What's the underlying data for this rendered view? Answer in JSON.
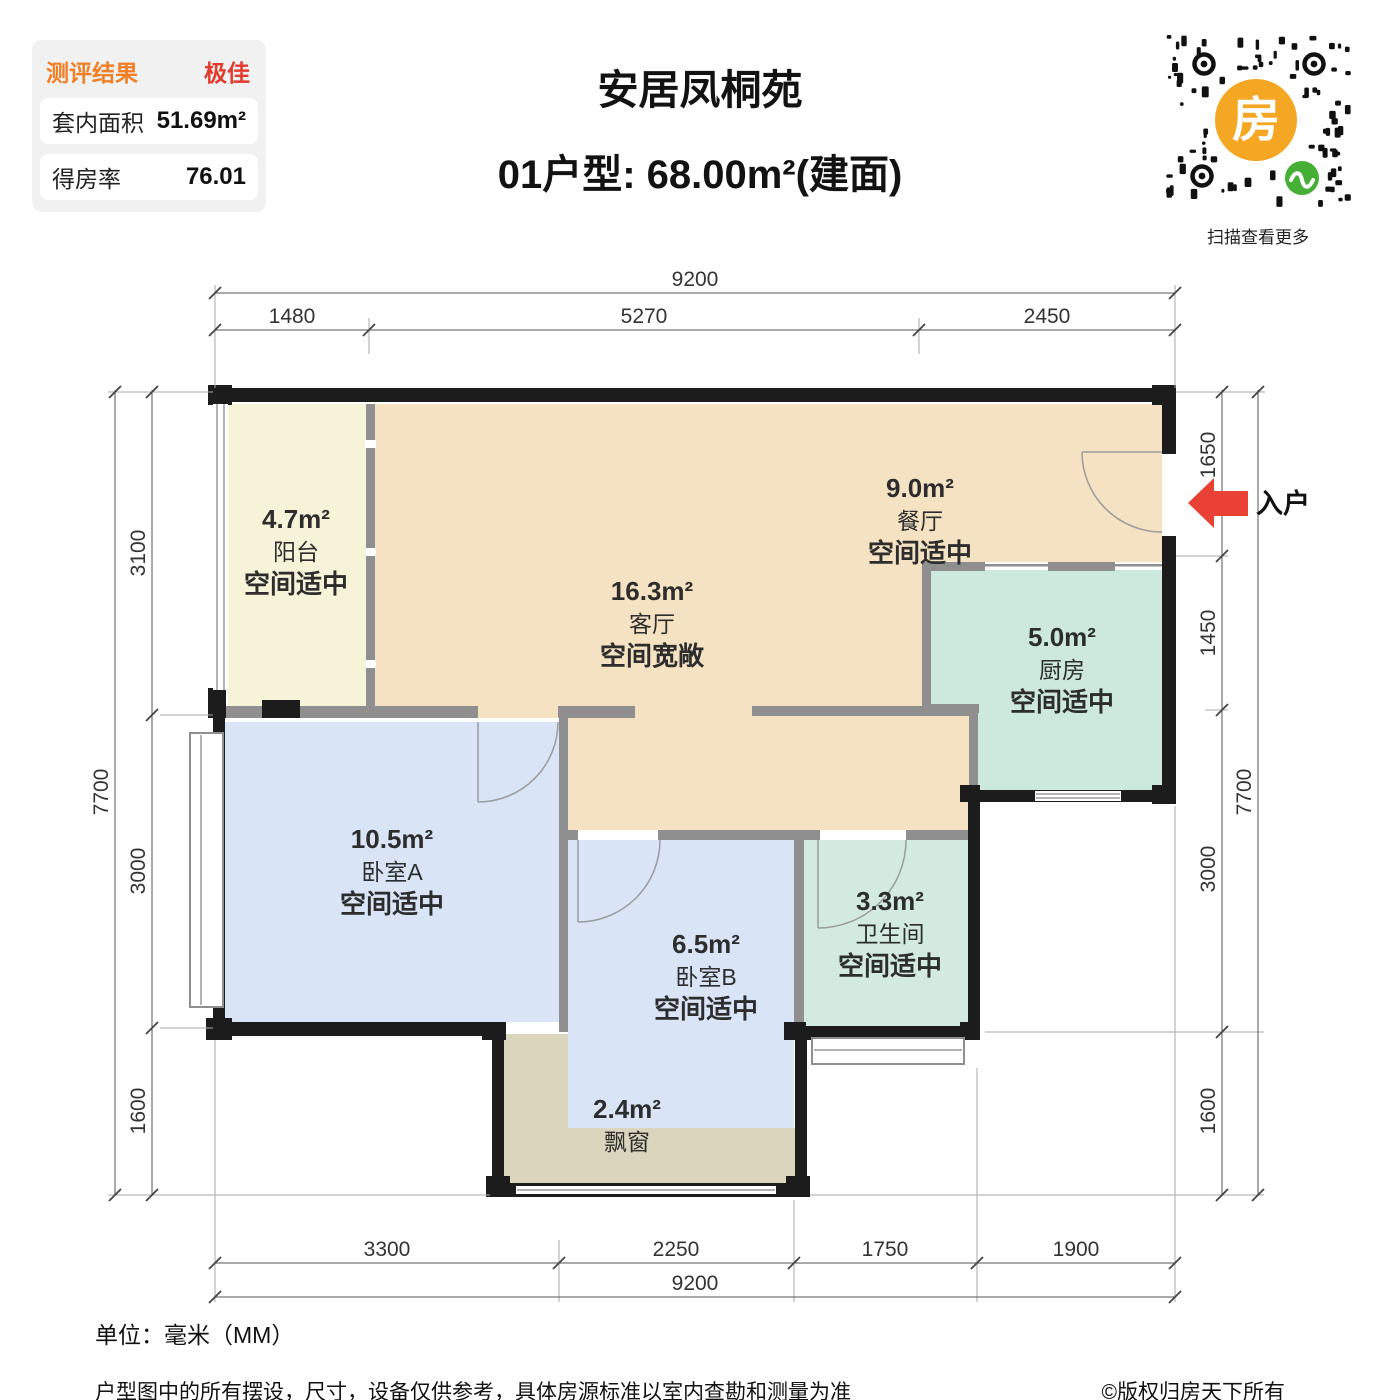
{
  "panel": {
    "header_label": "测评结果",
    "header_value": "极佳",
    "rows": [
      {
        "label": "套内面积",
        "value": "51.69m²"
      },
      {
        "label": "得房率",
        "value": "76.01"
      }
    ]
  },
  "header": {
    "title": "安居凤桐苑",
    "subtitle": "01户型: 68.00m²(建面)"
  },
  "qr": {
    "logo_char": "房",
    "caption": "扫描查看更多"
  },
  "entry": {
    "label": "入户",
    "arrow_color": "#E94133"
  },
  "rooms": [
    {
      "id": "balcony",
      "area": "4.7m²",
      "name": "阳台",
      "note": "空间适中",
      "color": "#F6F3D8"
    },
    {
      "id": "living",
      "area": "16.3m²",
      "name": "客厅",
      "note": "空间宽敞",
      "color": "#F5E2C3"
    },
    {
      "id": "dining",
      "area": "9.0m²",
      "name": "餐厅",
      "note": "空间适中",
      "color": "#F5E2C3"
    },
    {
      "id": "kitchen",
      "area": "5.0m²",
      "name": "厨房",
      "note": "空间适中",
      "color": "#CDE8DC"
    },
    {
      "id": "bedroomA",
      "area": "10.5m²",
      "name": "卧室A",
      "note": "空间适中",
      "color": "#D9E5F6"
    },
    {
      "id": "bedroomB",
      "area": "6.5m²",
      "name": "卧室B",
      "note": "空间适中",
      "color": "#D9E5F6"
    },
    {
      "id": "bathroom",
      "area": "3.3m²",
      "name": "卫生间",
      "note": "空间适中",
      "color": "#D2EAE0"
    },
    {
      "id": "baywindow",
      "area": "2.4m²",
      "name": "飘窗",
      "note": "",
      "color": "#DBD5BE"
    }
  ],
  "dimensions": {
    "top": {
      "total": "9200",
      "segments": [
        "1480",
        "5270",
        "2450"
      ]
    },
    "bottom": {
      "total": "9200",
      "segments": [
        "3300",
        "2250",
        "1750",
        "1900"
      ]
    },
    "left": {
      "total": "7700",
      "segments": [
        "3100",
        "3000",
        "1600"
      ]
    },
    "right": {
      "total": "7700",
      "segments": [
        "1650",
        "1450",
        "3000",
        "1600"
      ]
    }
  },
  "footer": {
    "unit": "单位：毫米（MM）",
    "disclaimer": "户型图中的所有摆设，尺寸，设备仅供参考，具体房源标准以室内查勘和测量为准",
    "copyright": "©版权归房天下所有"
  },
  "colors": {
    "rating_label": "#F07F26",
    "rating_value": "#E23B2E",
    "wall": "#1C1C1C",
    "interior_wall": "#8F8F8F",
    "qr_logo_bg": "#F5A623",
    "qr_badge": "#45B035"
  }
}
